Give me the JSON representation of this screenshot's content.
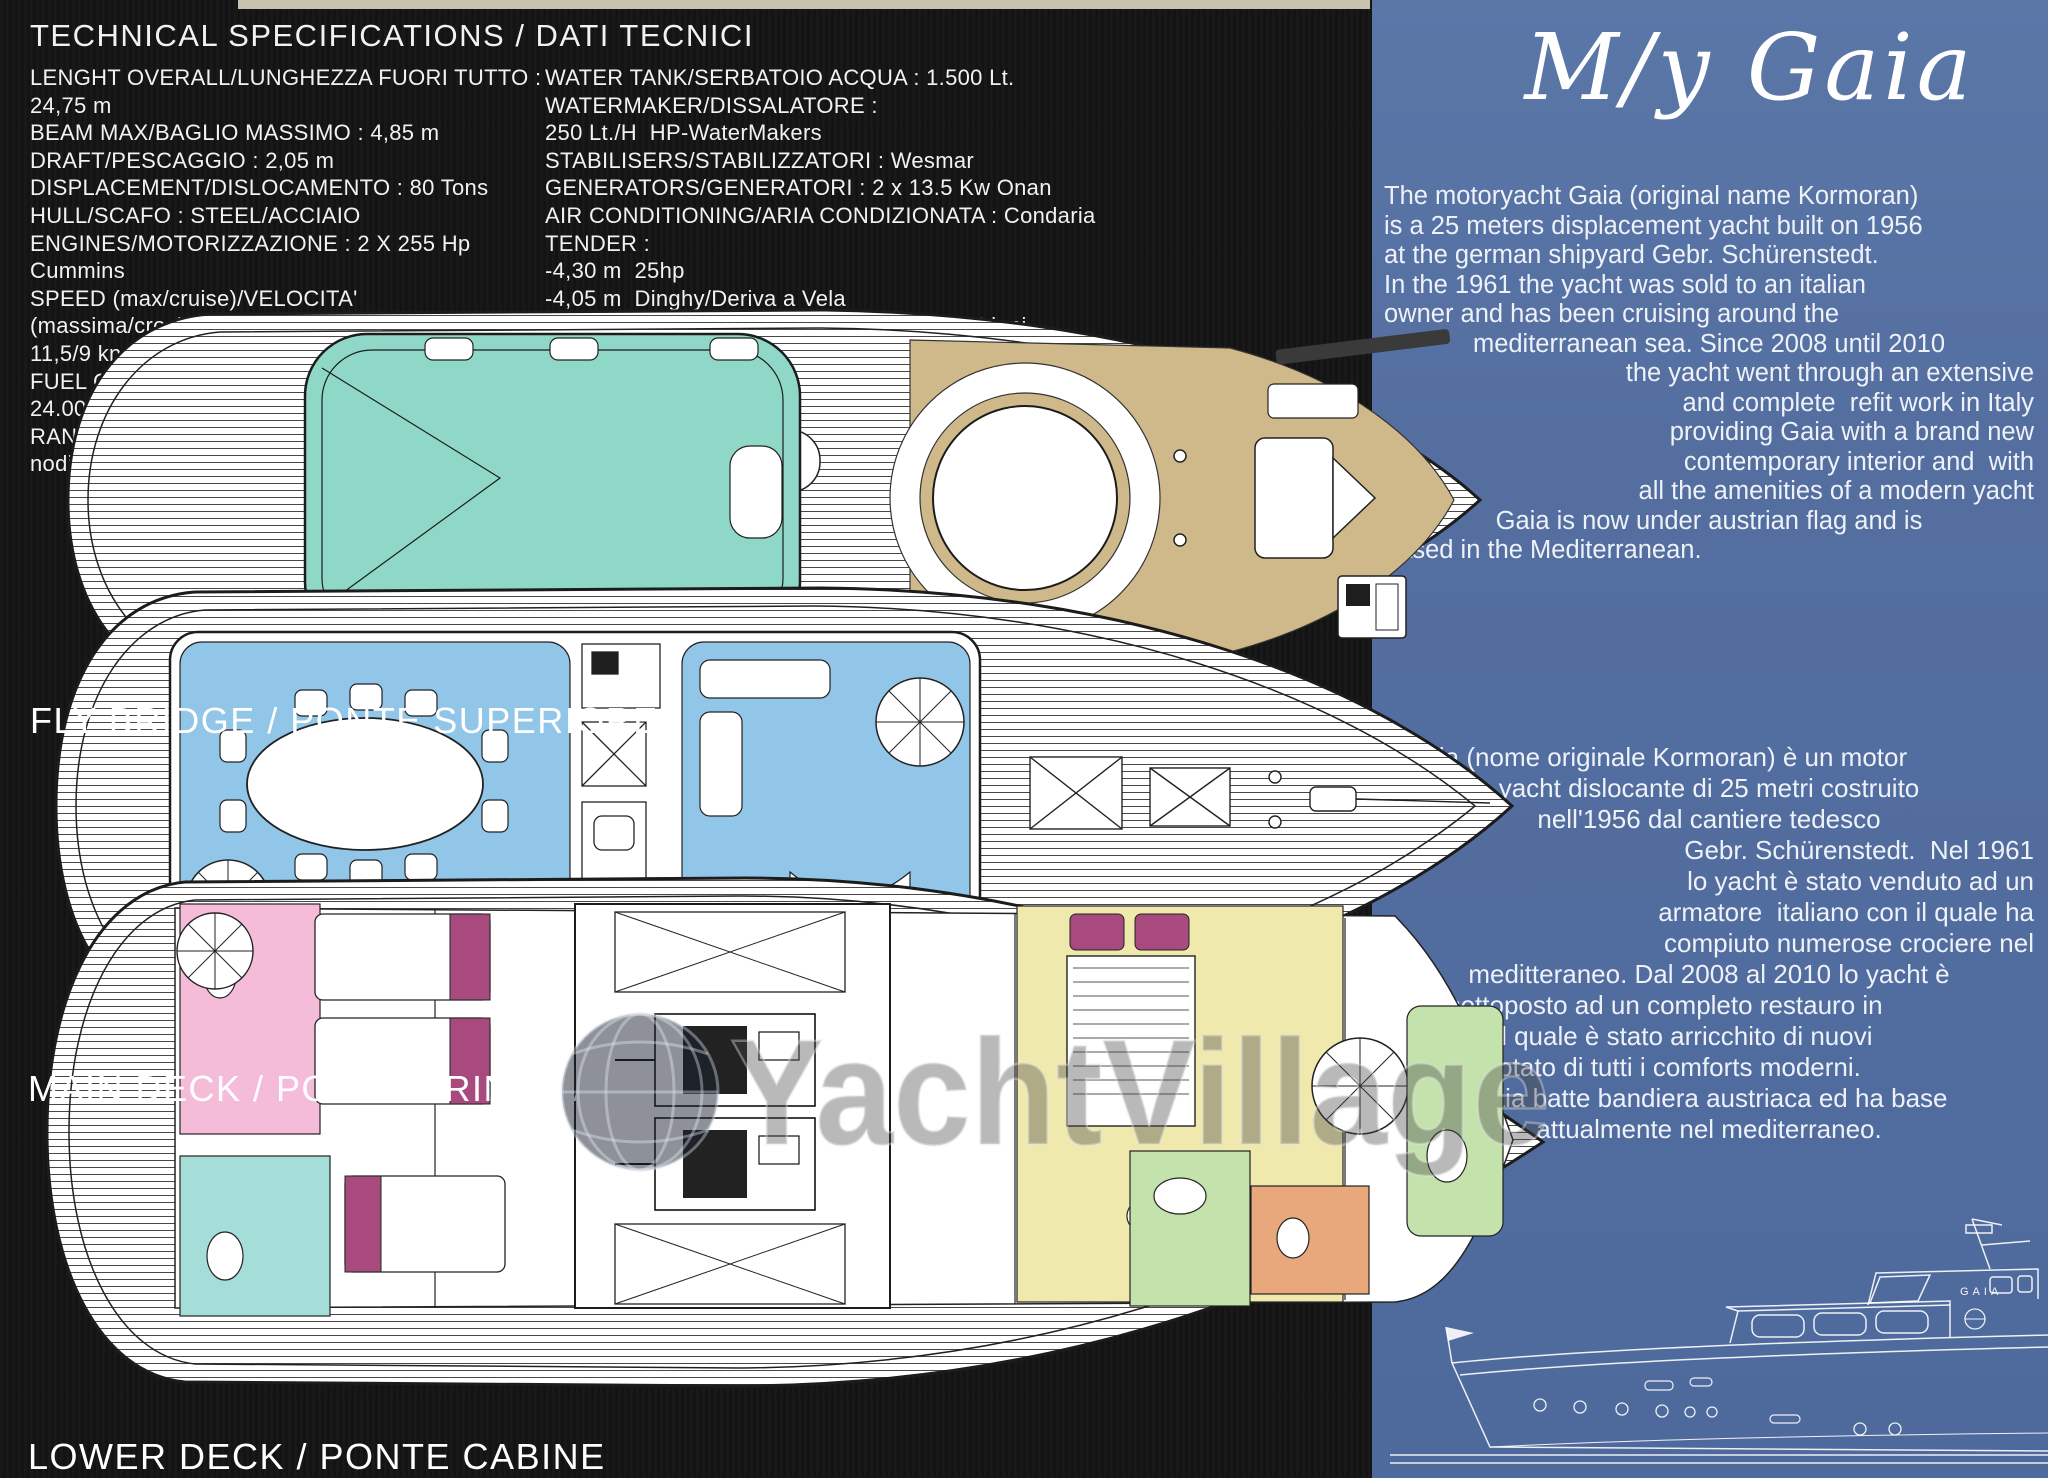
{
  "specs": {
    "title": "TECHNICAL SPECIFICATIONS / DATI TECNICI",
    "left_column": [
      "LENGHT OVERALL/LUNGHEZZA FUORI TUTTO :  24,75 m",
      "BEAM MAX/BAGLIO MASSIMO : 4,85 m",
      "DRAFT/PESCAGGIO : 2,05 m",
      "DISPLACEMENT/DISLOCAMENTO : 80 Tons",
      "HULL/SCAFO : STEEL/ACCIAIO",
      "ENGINES/MOTORIZZAZIONE : 2 X 255 Hp Cummins",
      "SPEED (max/cruise)/VELOCITA' (massima/crociera) :",
      "11,5/9 knots/nodi",
      "FUEL CAPACITY/SERBATOI CARBURANTE : 24.000 Lt.",
      "RANGE/AUTONOMIA : 6.000 Nm at 9knots/a 9 nodi"
    ],
    "right_column": [
      "WATER TANK/SERBATOIO ACQUA : 1.500 Lt.",
      "WATERMAKER/DISSALATORE :",
      "250 Lt./H  HP-WaterMakers",
      "STABILISERS/STABILIZZATORI : Wesmar",
      "GENERATORS/GENERATORI : 2 x 13.5 Kw Onan",
      "AIR CONDITIONING/ARIA CONDIZIONATA : Condaria",
      "TENDER :",
      "-4,30 m  25hp",
      "-4,05 m  Dinghy/Deriva a Vela",
      "ARCHITECT/ARCHITETTO : Arch. Alessio Liuni"
    ]
  },
  "decks": {
    "fly_bridge_label": "FLY BRIDGE / PONTE SUPERIORE",
    "main_deck_label": "MAIN DECK / PONTE PRINCIPALE",
    "lower_deck_label": "LOWER DECK / PONTE CABINE"
  },
  "panel": {
    "title": "M/y Gaia",
    "english": [
      {
        "text": "The motoryacht Gaia (original name Kormoran)",
        "align": "left"
      },
      {
        "text": "is a 25 meters displacement yacht built on 1956",
        "align": "left"
      },
      {
        "text": "at the german shipyard Gebr. Schürenstedt.",
        "align": "left"
      },
      {
        "text": "In the 1961 the yacht was sold to an italian",
        "align": "left"
      },
      {
        "text": "owner and has been cruising around the",
        "align": "left"
      },
      {
        "text": "mediterranean sea. Since 2008 until 2010",
        "align": "center"
      },
      {
        "text": "the yacht went through an extensive",
        "align": "right"
      },
      {
        "text": "and complete  refit work in Italy",
        "align": "right"
      },
      {
        "text": "providing Gaia with a brand new",
        "align": "right"
      },
      {
        "text": "contemporary interior and  with",
        "align": "right"
      },
      {
        "text": "all the amenities of a modern yacht",
        "align": "right"
      },
      {
        "text": "Gaia is now under austrian flag and is",
        "align": "center"
      },
      {
        "text": "based in the Mediterranean.",
        "align": "left"
      }
    ],
    "italian": [
      {
        "text": "Il Gaia (nome originale Kormoran) è un motor",
        "align": "left"
      },
      {
        "text": "yacht dislocante di 25 metri costruito",
        "align": "center"
      },
      {
        "text": "nell'1956 dal cantiere tedesco",
        "align": "center"
      },
      {
        "text": "Gebr. Schürenstedt.  Nel 1961",
        "align": "right"
      },
      {
        "text": "lo yacht è stato venduto ad un",
        "align": "right"
      },
      {
        "text": "armatore  italiano con il quale ha",
        "align": "right"
      },
      {
        "text": "compiuto numerose crociere nel",
        "align": "right"
      },
      {
        "text": "meditteraneo. Dal 2008 al 2010 lo yacht è",
        "align": "center"
      },
      {
        "text": "stato sottoposto ad un completo restauro in",
        "align": "left"
      },
      {
        "text": "Italia con il quale è stato arricchito di nuovi",
        "align": "left"
      },
      {
        "text": "interni e dotato di tutti i comforts moderni.",
        "align": "left"
      },
      {
        "text": "Gaia batte bandiera austriaca ed ha base",
        "align": "center"
      },
      {
        "text": "attualmente nel mediterraneo.",
        "align": "center"
      }
    ]
  },
  "watermark": {
    "text": "YachtVillage"
  },
  "sketch": {
    "boat_name": "GAIA"
  },
  "colors": {
    "panel_blue": "#546ea0",
    "page_black": "#141414",
    "deck_teak": "#cfb98a",
    "tender_teal": "#8fd8c8",
    "furniture_blue": "#92c6e8",
    "cabin_pink": "#f4bcd8",
    "bed_magenta": "#a84a7e",
    "bath_teal": "#a5ded8",
    "cabin_yellow": "#efe9ae",
    "cabin_green": "#c4e3ac",
    "cabin_orange": "#e8a87c"
  }
}
